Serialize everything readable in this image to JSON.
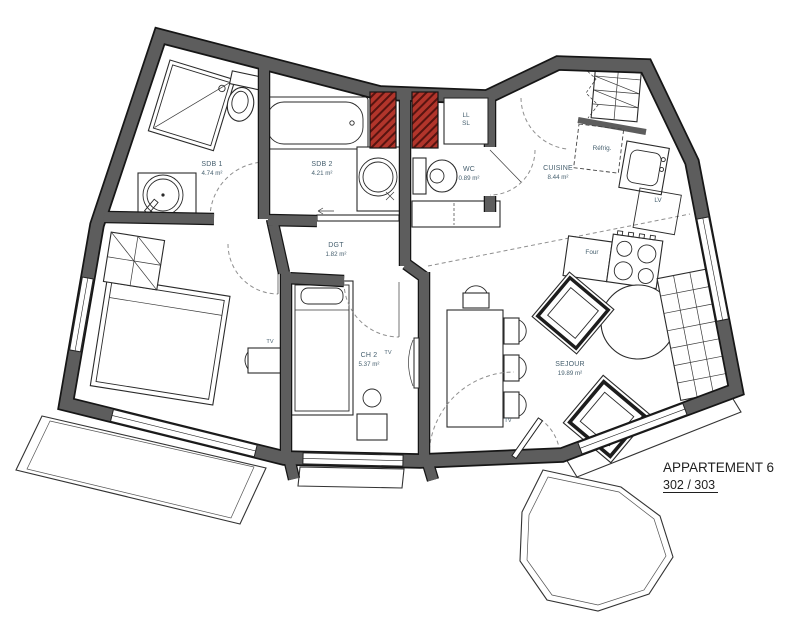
{
  "title": {
    "line1": "APPARTEMENT 6",
    "line2": "302 / 303"
  },
  "rooms": {
    "sdb1": {
      "name": "SDB 1",
      "area": "4.74 m²"
    },
    "sdb2": {
      "name": "SDB 2",
      "area": "4.21 m²"
    },
    "wc": {
      "name": "WC",
      "area": "0.89 m²"
    },
    "cuisine": {
      "name": "CUISINE",
      "area": "8.44 m²"
    },
    "dgt": {
      "name": "DGT",
      "area": "1.82 m²"
    },
    "ch2": {
      "name": "CH 2",
      "area": "5.37 m²"
    },
    "sejour": {
      "name": "SEJOUR",
      "area": "19.89 m²"
    }
  },
  "labels": {
    "fridge": "Réfrig.",
    "dishwasher": "LV",
    "oven": "Four",
    "washer": "LL",
    "dryer": "SL",
    "tv": "TV"
  },
  "colors": {
    "wall": "#5d5d5d",
    "wall_edge": "#161616",
    "shaft_red": "#b2352b",
    "label_text": "#47606f"
  }
}
